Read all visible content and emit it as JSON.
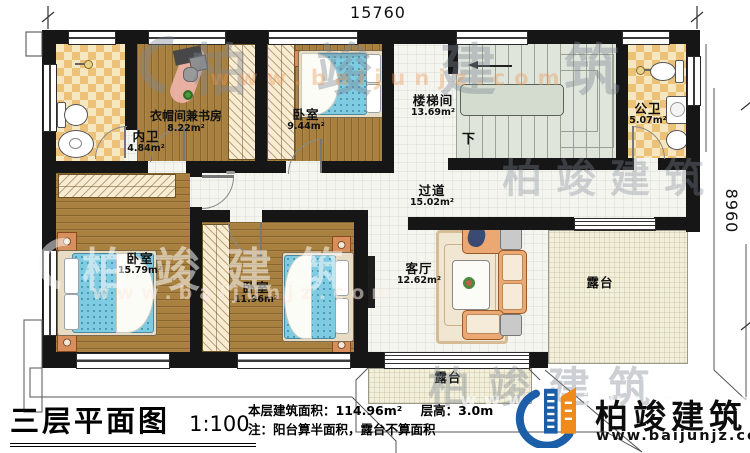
{
  "plan": {
    "title": "三层平面图",
    "scale": "1:100",
    "stat_area": "本层建筑面积：114.96m²",
    "stat_height": "层高：3.0m",
    "note": "注：阳台算半面积，露台不算面积",
    "dim_top": "15760",
    "dim_right": "8960",
    "stair_down_label": "下"
  },
  "rooms": [
    {
      "name": "内卫",
      "area": "4.84m²"
    },
    {
      "name": "衣帽间兼书房",
      "area": "8.22m²"
    },
    {
      "name": "卧室",
      "area": "9.44m²"
    },
    {
      "name": "楼梯间",
      "area": "13.69m²"
    },
    {
      "name": "公卫",
      "area": "5.07m²"
    },
    {
      "name": "过道",
      "area": "15.02m²"
    },
    {
      "name": "卧室",
      "area": "15.79m²"
    },
    {
      "name": "卧室",
      "area": "11.96m²"
    },
    {
      "name": "客厅",
      "area": "12.62m²"
    },
    {
      "name": "露台"
    },
    {
      "name": "露台"
    }
  ],
  "branding": {
    "company": "柏竣建筑",
    "website": "www.baijunjz.com"
  },
  "watermark": {
    "company": "柏竣建筑",
    "website": "www.baijunjz.com"
  },
  "colors": {
    "wall": "#161616",
    "wood": "#a8803f",
    "tile_light": "#f7e7c0",
    "tile_dark": "#ecc178",
    "floor_white": "#f5f5f0",
    "terrace": "#f2efda",
    "stair": "#dfe5db",
    "bed_blue": "#7fcbe2",
    "logo_blue": "#1c5fa8",
    "logo_orange": "#ef8a1d"
  }
}
